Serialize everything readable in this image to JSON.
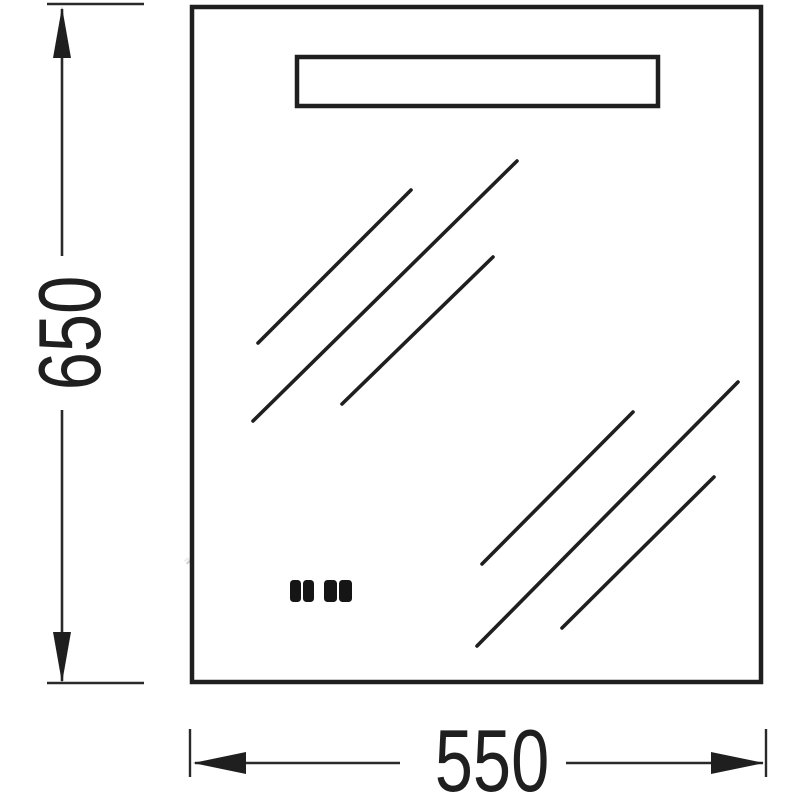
{
  "diagram": {
    "type": "technical-dimension-drawing",
    "subject": "bathroom-mirror-with-led-light-panel-front-view",
    "dimensions": {
      "height_label": "650",
      "width_label": "550"
    },
    "watermark": "www.aquamir.ru",
    "colors": {
      "background": "#ffffff",
      "line": "#1f1f1f",
      "watermark_fill": "#ffffff",
      "watermark_shadow": "#d2d2d2"
    },
    "icons": {
      "touch_sensor": "touch-sensor-buttons-icon",
      "shine": "glass-shine-lines"
    }
  }
}
